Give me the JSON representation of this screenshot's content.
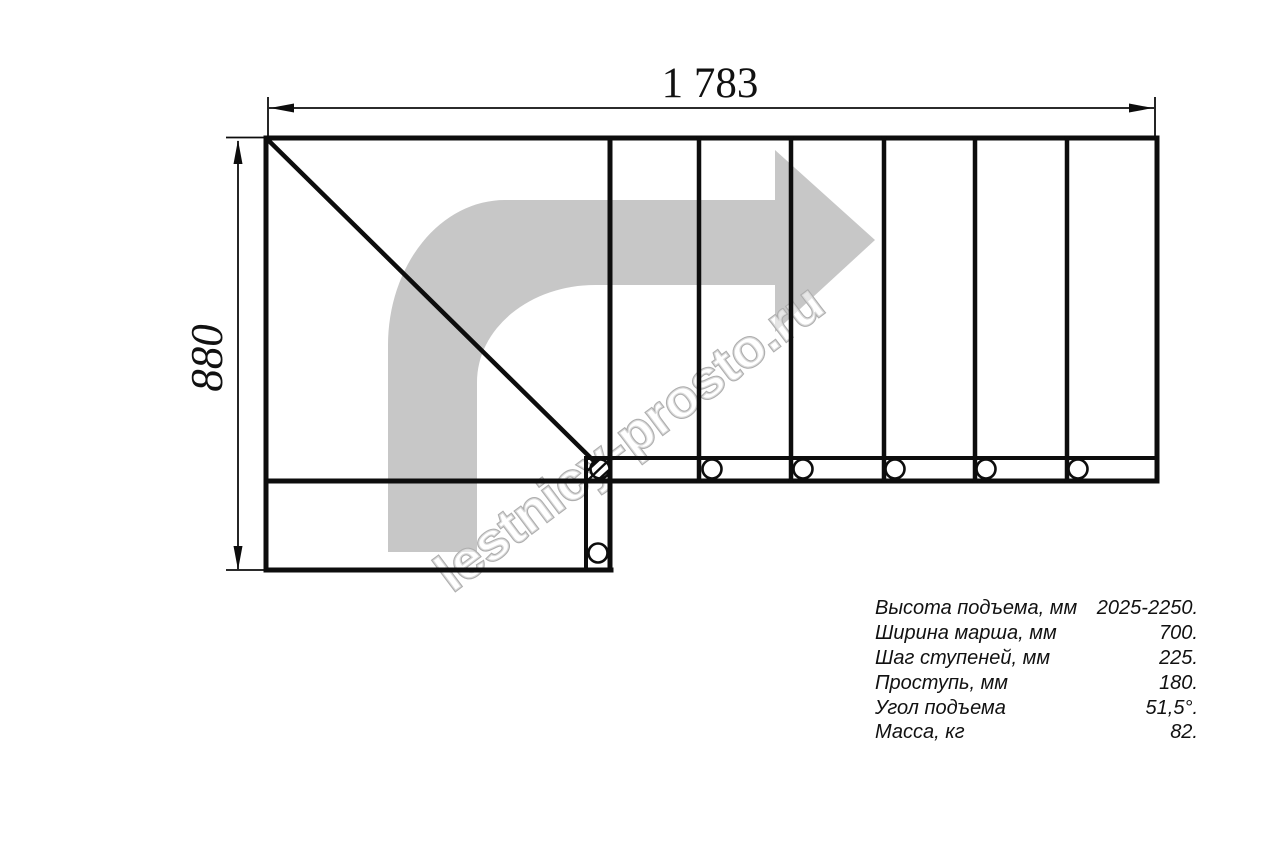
{
  "drawing": {
    "dim_width_label": "1 783",
    "dim_height_label": "880",
    "watermark": "lestnicy-prosto.ru",
    "colors": {
      "line": "#0d0d0d",
      "arrow_gray": "#c7c7c7",
      "watermark_outline": "#aeaeae"
    }
  },
  "specs": {
    "rows": [
      {
        "label": "Высота подъема, мм",
        "value": "2025-2250."
      },
      {
        "label": "Ширина марша, мм",
        "value": "700."
      },
      {
        "label": "Шаг ступеней, мм",
        "value": "225."
      },
      {
        "label": "Проступь, мм",
        "value": "180."
      },
      {
        "label": "Угол подъема",
        "value": "51,5°."
      },
      {
        "label": "Масса, кг",
        "value": "82."
      }
    ]
  }
}
